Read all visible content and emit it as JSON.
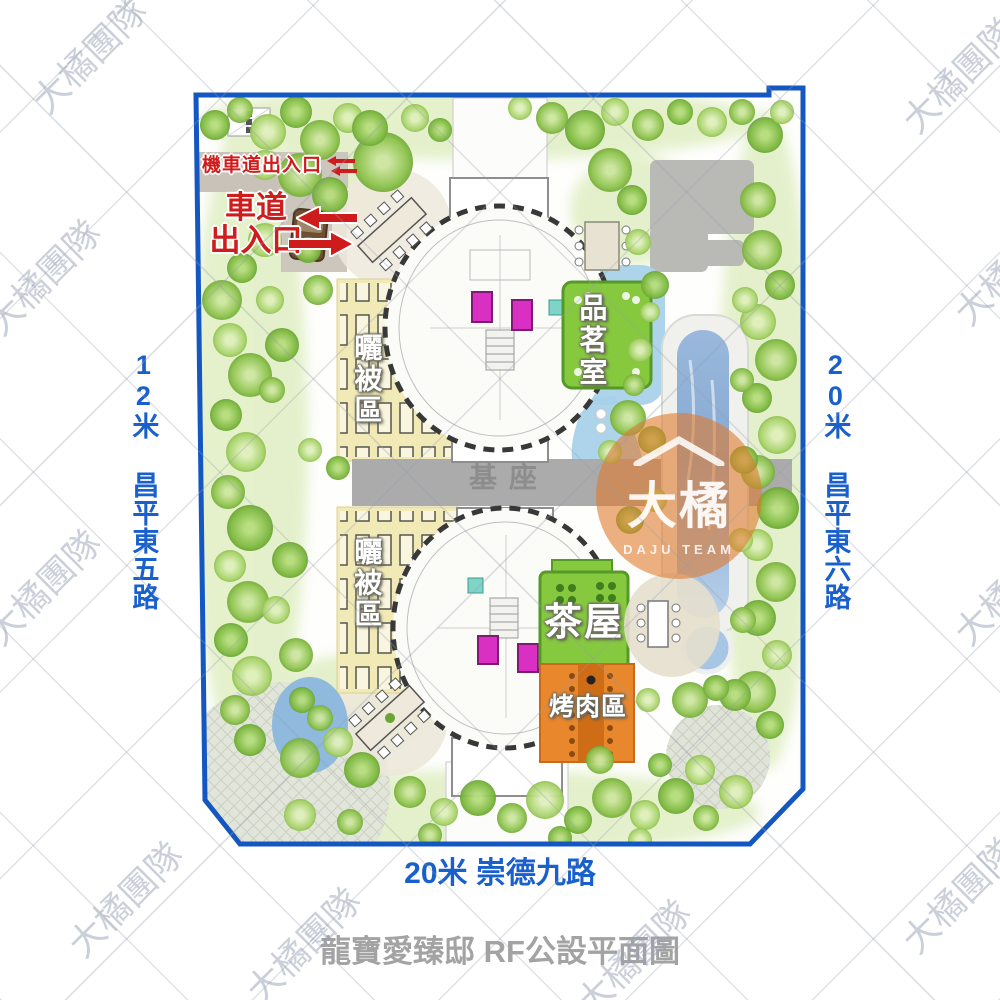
{
  "plan": {
    "moto_entrance": "機車道出入口",
    "drive_entrance_line1": "車道",
    "drive_entrance_line2": "出入口",
    "sun_area": "曬被區",
    "base": "基座",
    "tea_tasting_room": "品茗室",
    "tea_house": "茶屋",
    "bbq_area": "烤肉區"
  },
  "roads": {
    "left": "12米 昌平東五路",
    "right": "20米 昌平東六路",
    "bottom": "20米 崇德九路"
  },
  "title": "龍寶愛臻邸 RF公設平面圖",
  "watermark": {
    "corner_text": "大橘團隊",
    "center_main": "大橘",
    "center_sub": "DAJU TEAM"
  },
  "colors": {
    "border_blue": "#1557c0",
    "road_text_blue": "#1a60cc",
    "entrance_red": "#cf1d1d",
    "deck_green": "#86c93f",
    "bbq_orange": "#e9872d",
    "base_gray": "#ababab",
    "sun_area_yellow": "#f1e9b6",
    "pool_blue": "#86a9d2",
    "watermark_orange": "rgba(224,122,45,0.60)"
  }
}
